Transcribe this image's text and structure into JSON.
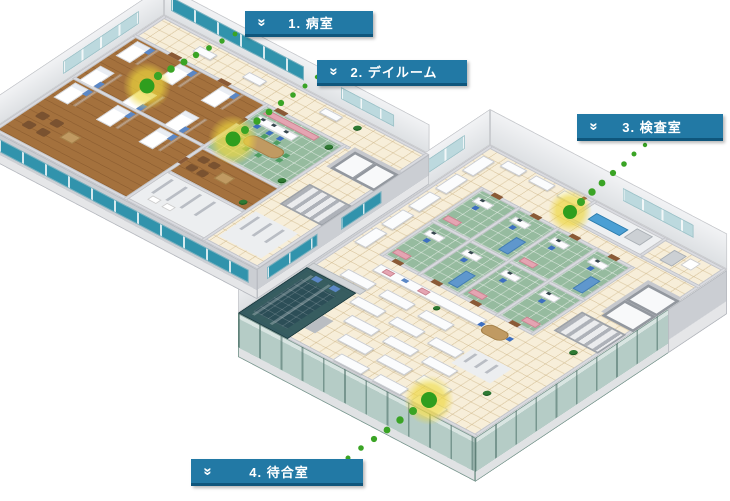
{
  "callouts": [
    {
      "number": "1",
      "label": "1. 病室"
    },
    {
      "number": "2",
      "label": "2. デイルーム"
    },
    {
      "number": "3",
      "label": "3. 検査室"
    },
    {
      "number": "4",
      "label": "4. 待合室"
    }
  ],
  "icons": {
    "callout_chevron_glyph": "»",
    "callout_chevron_name": "double-chevron-down-icon"
  },
  "colors": {
    "callout_bg": "#2279a5",
    "callout_border_bottom": "#0f567c",
    "callout_text": "#ffffff",
    "leader_dot_green": "#3aa425",
    "marker_dot_green": "#2f9e1e",
    "marker_highlight_yellow": "#eed73c"
  }
}
